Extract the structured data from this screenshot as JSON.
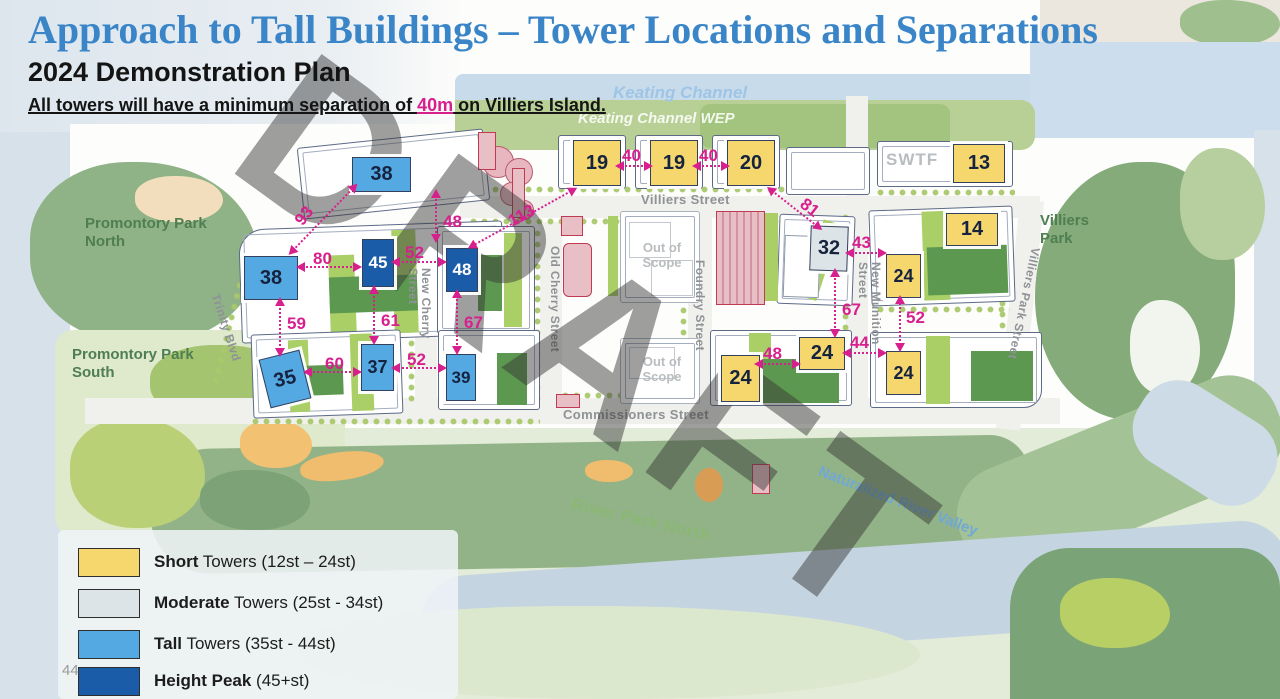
{
  "header": {
    "title": "Approach to Tall Buildings – Tower Locations and Separations",
    "subtitle": "2024 Demonstration Plan",
    "note": {
      "prefix": "All towers will have a minimum separation of ",
      "highlight": "40m",
      "suffix": " on Villiers Island."
    }
  },
  "watermark": "DRAFT",
  "page_number": "44",
  "colors": {
    "title_blue": "#3a85c8",
    "separation_magenta": "#d81f8e",
    "short_tower": "#F5D76E",
    "moderate_tower": "#DCE4E8",
    "tall_tower": "#55A9E3",
    "height_peak": "#1B5CA9"
  },
  "legend": {
    "items": [
      {
        "swatch": "#F5D76E",
        "bold": "Short",
        "rest": " Towers (12st – 24st)"
      },
      {
        "swatch": "#DCE4E8",
        "bold": "Moderate",
        "rest": " Towers (25st - 34st)"
      },
      {
        "swatch": "#55A9E3",
        "bold": "Tall",
        "rest": " Towers  (35st - 44st)"
      },
      {
        "swatch": "#1B5CA9",
        "bold": "Height Peak",
        "rest": " (45+st)"
      }
    ]
  },
  "map": {
    "labels": {
      "keating_channel": "Keating Channel",
      "keating_channel_wep": "Keating Channel WEP",
      "villiers_street": "Villiers Street",
      "commissioners_street": "Commissioners Street",
      "trinity_blvd": "Trinity Blvd",
      "new_cherry_street": "New Cherry Street",
      "old_cherry_street": "Old Cherry Street",
      "foundry_street": "Foundry Street",
      "new_munition_street": "New Munition Street",
      "villiers_park_street": "Villiers Park Street",
      "promontory_park_north": "Promontory Park North",
      "promontory_park_south": "Promontory Park South",
      "villiers_park": "Villiers Park",
      "river_park_north": "River Park North",
      "naturalized_river_valley": "Naturalized River Valley",
      "swtf": "SWTF",
      "out_of_scope": "Out of Scope"
    },
    "towers": [
      {
        "id": "tower-38-north",
        "label": "38",
        "category": "tall"
      },
      {
        "id": "tower-19-a",
        "label": "19",
        "category": "short"
      },
      {
        "id": "tower-19-b",
        "label": "19",
        "category": "short"
      },
      {
        "id": "tower-20",
        "label": "20",
        "category": "short"
      },
      {
        "id": "tower-13",
        "label": "13",
        "category": "short"
      },
      {
        "id": "tower-38-west",
        "label": "38",
        "category": "tall"
      },
      {
        "id": "tower-45",
        "label": "45",
        "category": "height-peak"
      },
      {
        "id": "tower-48",
        "label": "48",
        "category": "height-peak"
      },
      {
        "id": "tower-32",
        "label": "32",
        "category": "moderate"
      },
      {
        "id": "tower-14",
        "label": "14",
        "category": "short"
      },
      {
        "id": "tower-24-northeast",
        "label": "24",
        "category": "short"
      },
      {
        "id": "tower-35",
        "label": "35",
        "category": "tall"
      },
      {
        "id": "tower-37",
        "label": "37",
        "category": "tall"
      },
      {
        "id": "tower-39",
        "label": "39",
        "category": "tall"
      },
      {
        "id": "tower-24-mid-west",
        "label": "24",
        "category": "short"
      },
      {
        "id": "tower-24-mid-east",
        "label": "24",
        "category": "short"
      },
      {
        "id": "tower-24-southeast",
        "label": "24",
        "category": "short"
      }
    ],
    "separations": [
      {
        "between": "19 and 19",
        "value": "40"
      },
      {
        "between": "19 and 20",
        "value": "40"
      },
      {
        "between": "20 and 32",
        "value": "81"
      },
      {
        "between": "38 north and 38 west",
        "value": "93"
      },
      {
        "between": "38 north and 45",
        "value": "48"
      },
      {
        "between": "38 west and 45",
        "value": "80"
      },
      {
        "between": "45 and 48",
        "value": "52"
      },
      {
        "between": "48 and 19",
        "value": "113"
      },
      {
        "between": "38 west and 35",
        "value": "59"
      },
      {
        "between": "45 and 37",
        "value": "61"
      },
      {
        "between": "48 and 39",
        "value": "67"
      },
      {
        "between": "35 and 37",
        "value": "60"
      },
      {
        "between": "37 and 39",
        "value": "52"
      },
      {
        "between": "32 and 24 northeast",
        "value": "43"
      },
      {
        "between": "32 and 24 mid-east",
        "value": "67"
      },
      {
        "between": "24 mid-west and 24 mid-east",
        "value": "48"
      },
      {
        "between": "24 mid-east and 24 southeast",
        "value": "44"
      },
      {
        "between": "24 northeast and 24 southeast",
        "value": "52"
      }
    ]
  }
}
